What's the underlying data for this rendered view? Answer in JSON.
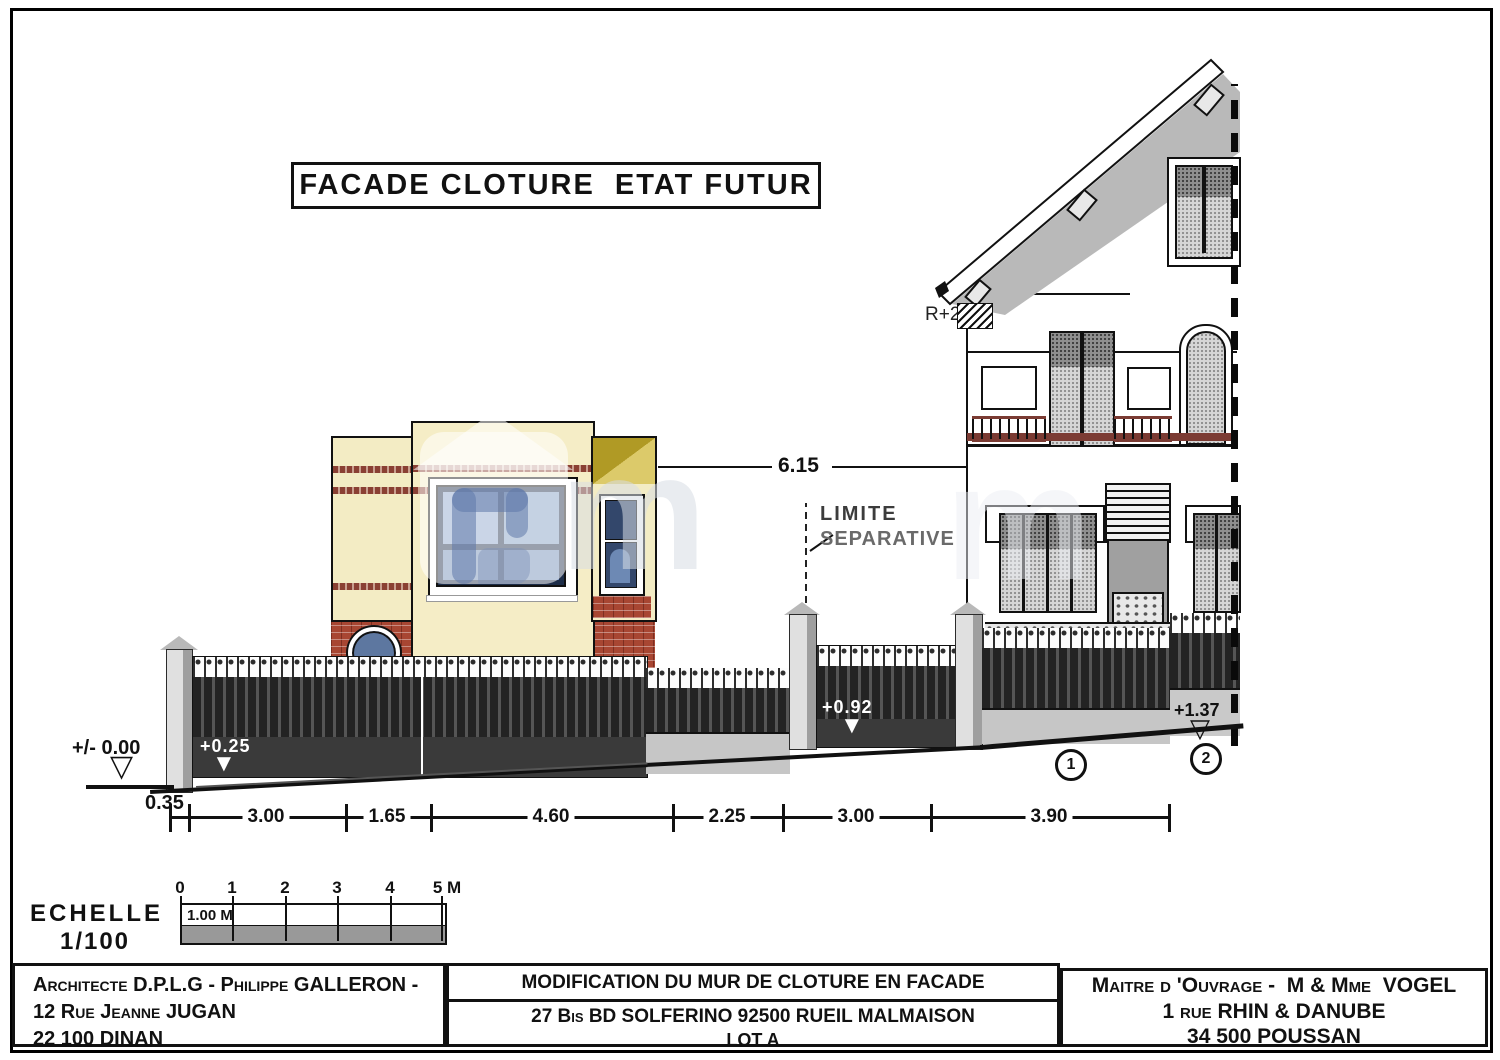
{
  "title": "FACADE CLOTURE  ETAT FUTUR",
  "annotations": {
    "r2": "R+2",
    "limite1": "LIMITE",
    "limite2": "SEPARATIVE",
    "span": "6.15"
  },
  "levels": {
    "datum": "+/- 0.00",
    "offset": "0.35",
    "wall1": "+0.25",
    "gate": "+0.92",
    "wall2": "+1.37"
  },
  "dims": [
    "3.00",
    "1.65",
    "4.60",
    "2.25",
    "3.00",
    "3.90"
  ],
  "markers": {
    "m1": "1",
    "m2": "2"
  },
  "scale": {
    "name1": "ECHELLE",
    "name2": "1/100",
    "ticks": [
      "0",
      "1",
      "2",
      "3",
      "4",
      "5 M"
    ],
    "unit": "1.00 M"
  },
  "titleblock": {
    "architect": [
      "Architecte D.P.L.G - Philippe GALLERON -",
      "12 Rue Jeanne JUGAN",
      "22 100 DINAN"
    ],
    "project_title": "MODIFICATION DU MUR DE CLOTURE EN FACADE",
    "project_address": "27 Bis BD SOLFERINO 92500 RUEIL MALMAISON",
    "project_lot": "LOT A",
    "owner": [
      "Maitre d 'Ouvrage -  M & Mme  VOGEL",
      "1 rue RHIN & DANUBE",
      "34 500 POUSSAN"
    ]
  },
  "colors": {
    "wall_cream": "#f3ecc4",
    "brick_red": "#a84632",
    "window_blue": "#7e9cc2",
    "frame_navy": "#1d2d49",
    "fence_dark": "#232323",
    "wall_gray": "#c6c6c6",
    "roof_gray": "#b9b9b9",
    "balcony_maroon": "#7b3b33",
    "olive_roof": "#b09a25"
  }
}
